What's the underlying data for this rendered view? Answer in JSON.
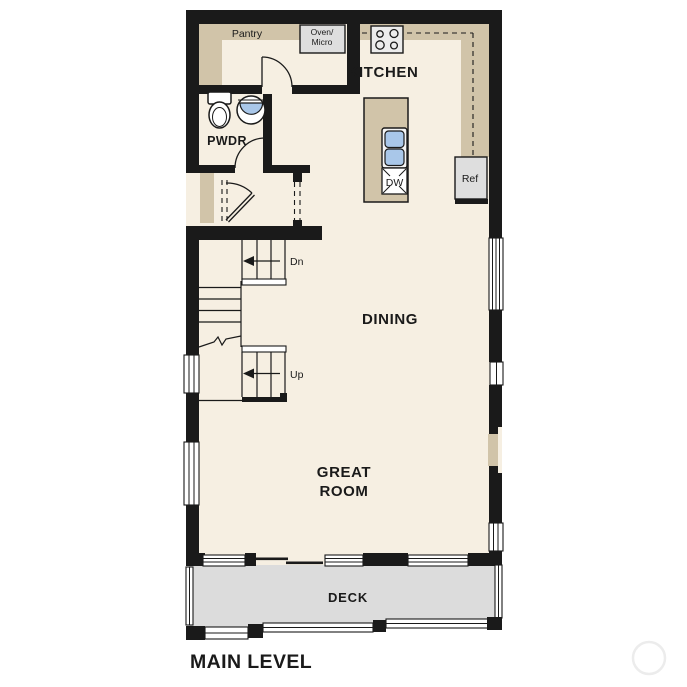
{
  "title": {
    "main_level": "MAIN LEVEL"
  },
  "rooms": {
    "kitchen": "KITCHEN",
    "dining": "DINING",
    "great_room_line1": "GREAT",
    "great_room_line2": "ROOM",
    "deck": "DECK",
    "pwdr": "PWDR",
    "pantry": "Pantry"
  },
  "fixtures": {
    "oven_micro_line1": "Oven/",
    "oven_micro_line2": "Micro",
    "dishwasher": "DW",
    "refrigerator": "Ref",
    "stairs_down": "Dn",
    "stairs_up": "Up"
  },
  "colors": {
    "wall": "#1a1a1a",
    "floor": "#f6efe2",
    "counter": "#d1c4a9",
    "deck": "#dcdcdc",
    "appliance": "#dedede",
    "sink_water": "#a9c7e9",
    "ink": "#1a1a1a",
    "watermark": "#ececec"
  }
}
